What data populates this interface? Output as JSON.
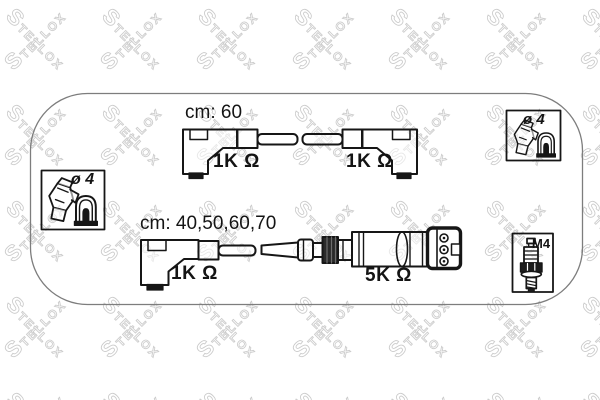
{
  "watermark": {
    "text": "STELLOX",
    "initial": "S",
    "rest": "TELLOX"
  },
  "cables": {
    "top": {
      "length_label": "cm: 60",
      "left_resistor": "1K Ω",
      "right_resistor": "1K Ω"
    },
    "bottom": {
      "length_label": "cm: 40,50,60,70",
      "left_resistor": "1K Ω",
      "right_resistor": "5K Ω"
    }
  },
  "callouts": {
    "left_terminal_box": {
      "label": "ø 4"
    },
    "right_terminal_box": {
      "label": "ø 4"
    },
    "spark_plug_box": {
      "label": "M4"
    }
  },
  "colors": {
    "line": "#161616",
    "frame_border": "#7d7d7d",
    "watermark": "#cbcbcb",
    "background": "#ffffff"
  }
}
